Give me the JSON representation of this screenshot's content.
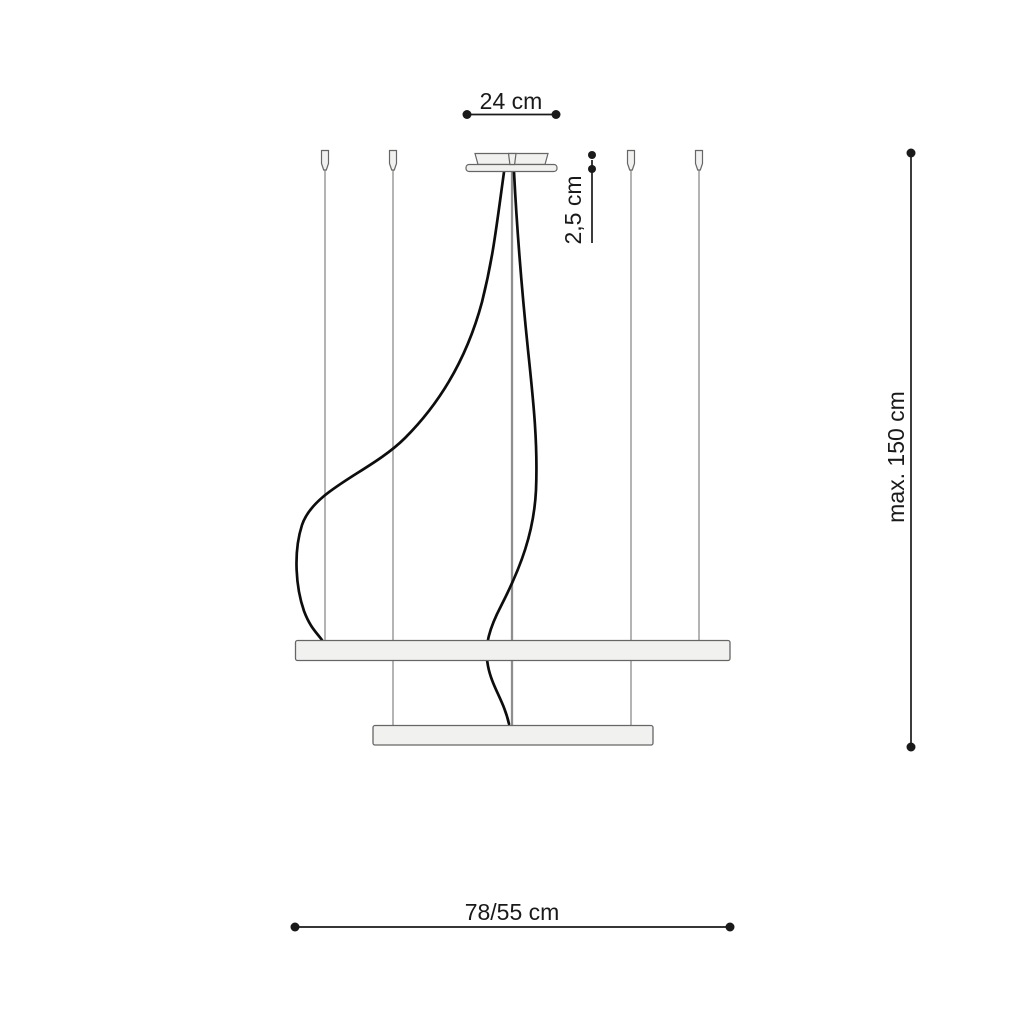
{
  "drawing": {
    "labels": {
      "canopy_width": "24 cm",
      "canopy_height": "2,5 cm",
      "suspension_height": "max. 150 cm",
      "ring_diameters": "78/55 cm"
    },
    "colors": {
      "background": "#ffffff",
      "line": "#1a1a1a",
      "wire": "#9b9b9b",
      "rod": "#8f8f8f",
      "cable": "#0d0d0d",
      "fixture_fill": "#f1f1ef",
      "fixture_stroke": "#666666"
    }
  }
}
